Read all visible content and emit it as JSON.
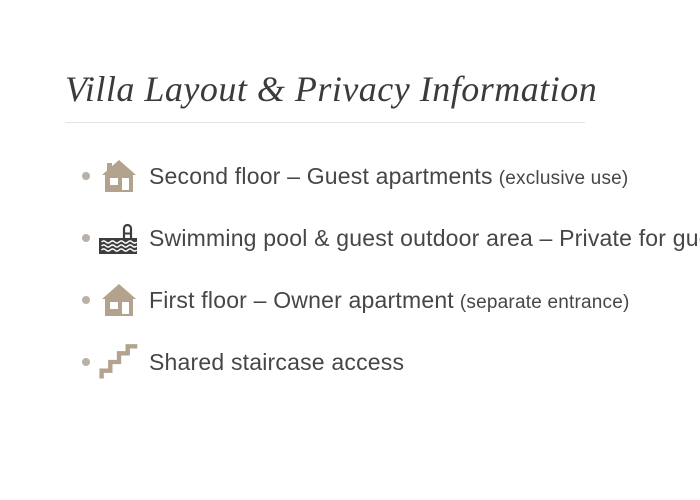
{
  "page": {
    "title": "Villa Layout & Privacy Information"
  },
  "list": {
    "items": [
      {
        "icon": "house-icon",
        "text": "Second floor – Guest apartments",
        "note": "(exclusive use)"
      },
      {
        "icon": "pool-icon",
        "text": "Swimming pool & guest outdoor area – Private for guests",
        "note": ""
      },
      {
        "icon": "house-icon",
        "text": "First floor – Owner apartment",
        "note": "(separate entrance)"
      },
      {
        "icon": "stairs-icon",
        "text": "Shared staircase access",
        "note": ""
      }
    ]
  },
  "colors": {
    "background": "#ffffff",
    "title_text": "#3b3b3b",
    "body_text": "#464646",
    "divider": "#e4e4e4",
    "bullet": "#b9b0a6",
    "icon_tan": "#b2a28e",
    "icon_dark": "#3d3d3d",
    "icon_cutout": "#ffffff"
  }
}
